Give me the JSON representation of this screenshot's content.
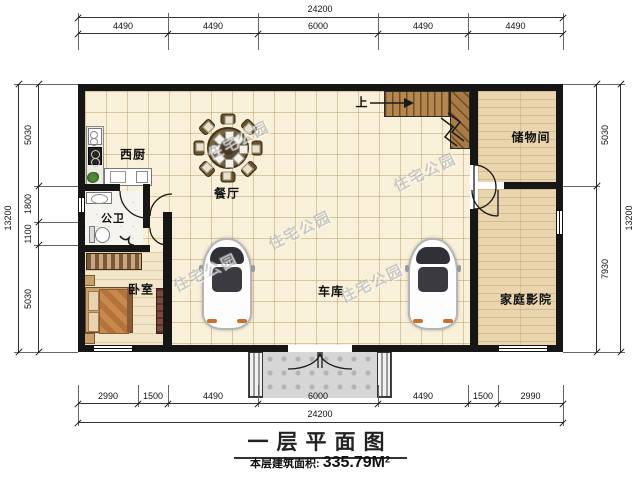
{
  "plan": {
    "rooms": {
      "kitchen": {
        "label": "西厨"
      },
      "dining": {
        "label": "餐厅"
      },
      "bathroom": {
        "label": "公卫"
      },
      "bedroom": {
        "label": "卧室"
      },
      "garage": {
        "label": "车库"
      },
      "storage": {
        "label": "储物间"
      },
      "home_theater": {
        "label": "家庭影院"
      },
      "stairs_up": {
        "label": "上"
      }
    },
    "watermark": {
      "text": "住宅公园"
    }
  },
  "dimensions": {
    "top": {
      "total": "24200",
      "segments": [
        "4490",
        "4490",
        "6000",
        "4490",
        "4490"
      ]
    },
    "bottom": {
      "total": "24200",
      "segments": [
        "2990",
        "1500",
        "4490",
        "6000",
        "4490",
        "1500",
        "2990"
      ]
    },
    "left": {
      "total": "13200",
      "segments": [
        "5030",
        "1800",
        "1100",
        "5030"
      ]
    },
    "right": {
      "total": "13200",
      "segments": [
        "5030",
        "7930"
      ]
    }
  },
  "title": {
    "main": "一层平面图",
    "area_label": "本层建筑面积:",
    "area_value": "335.79M",
    "area_sup": "2"
  },
  "colors": {
    "wall": "#161616",
    "tile_floor": "#f8f0d8",
    "wood_floor": "#e9d6ae",
    "stair_wood": "#b5874e",
    "porch": "#d6d6d6",
    "accent_quilt": "#c8894e",
    "car_glass": "#303036",
    "taillight": "#cd6f2a"
  }
}
